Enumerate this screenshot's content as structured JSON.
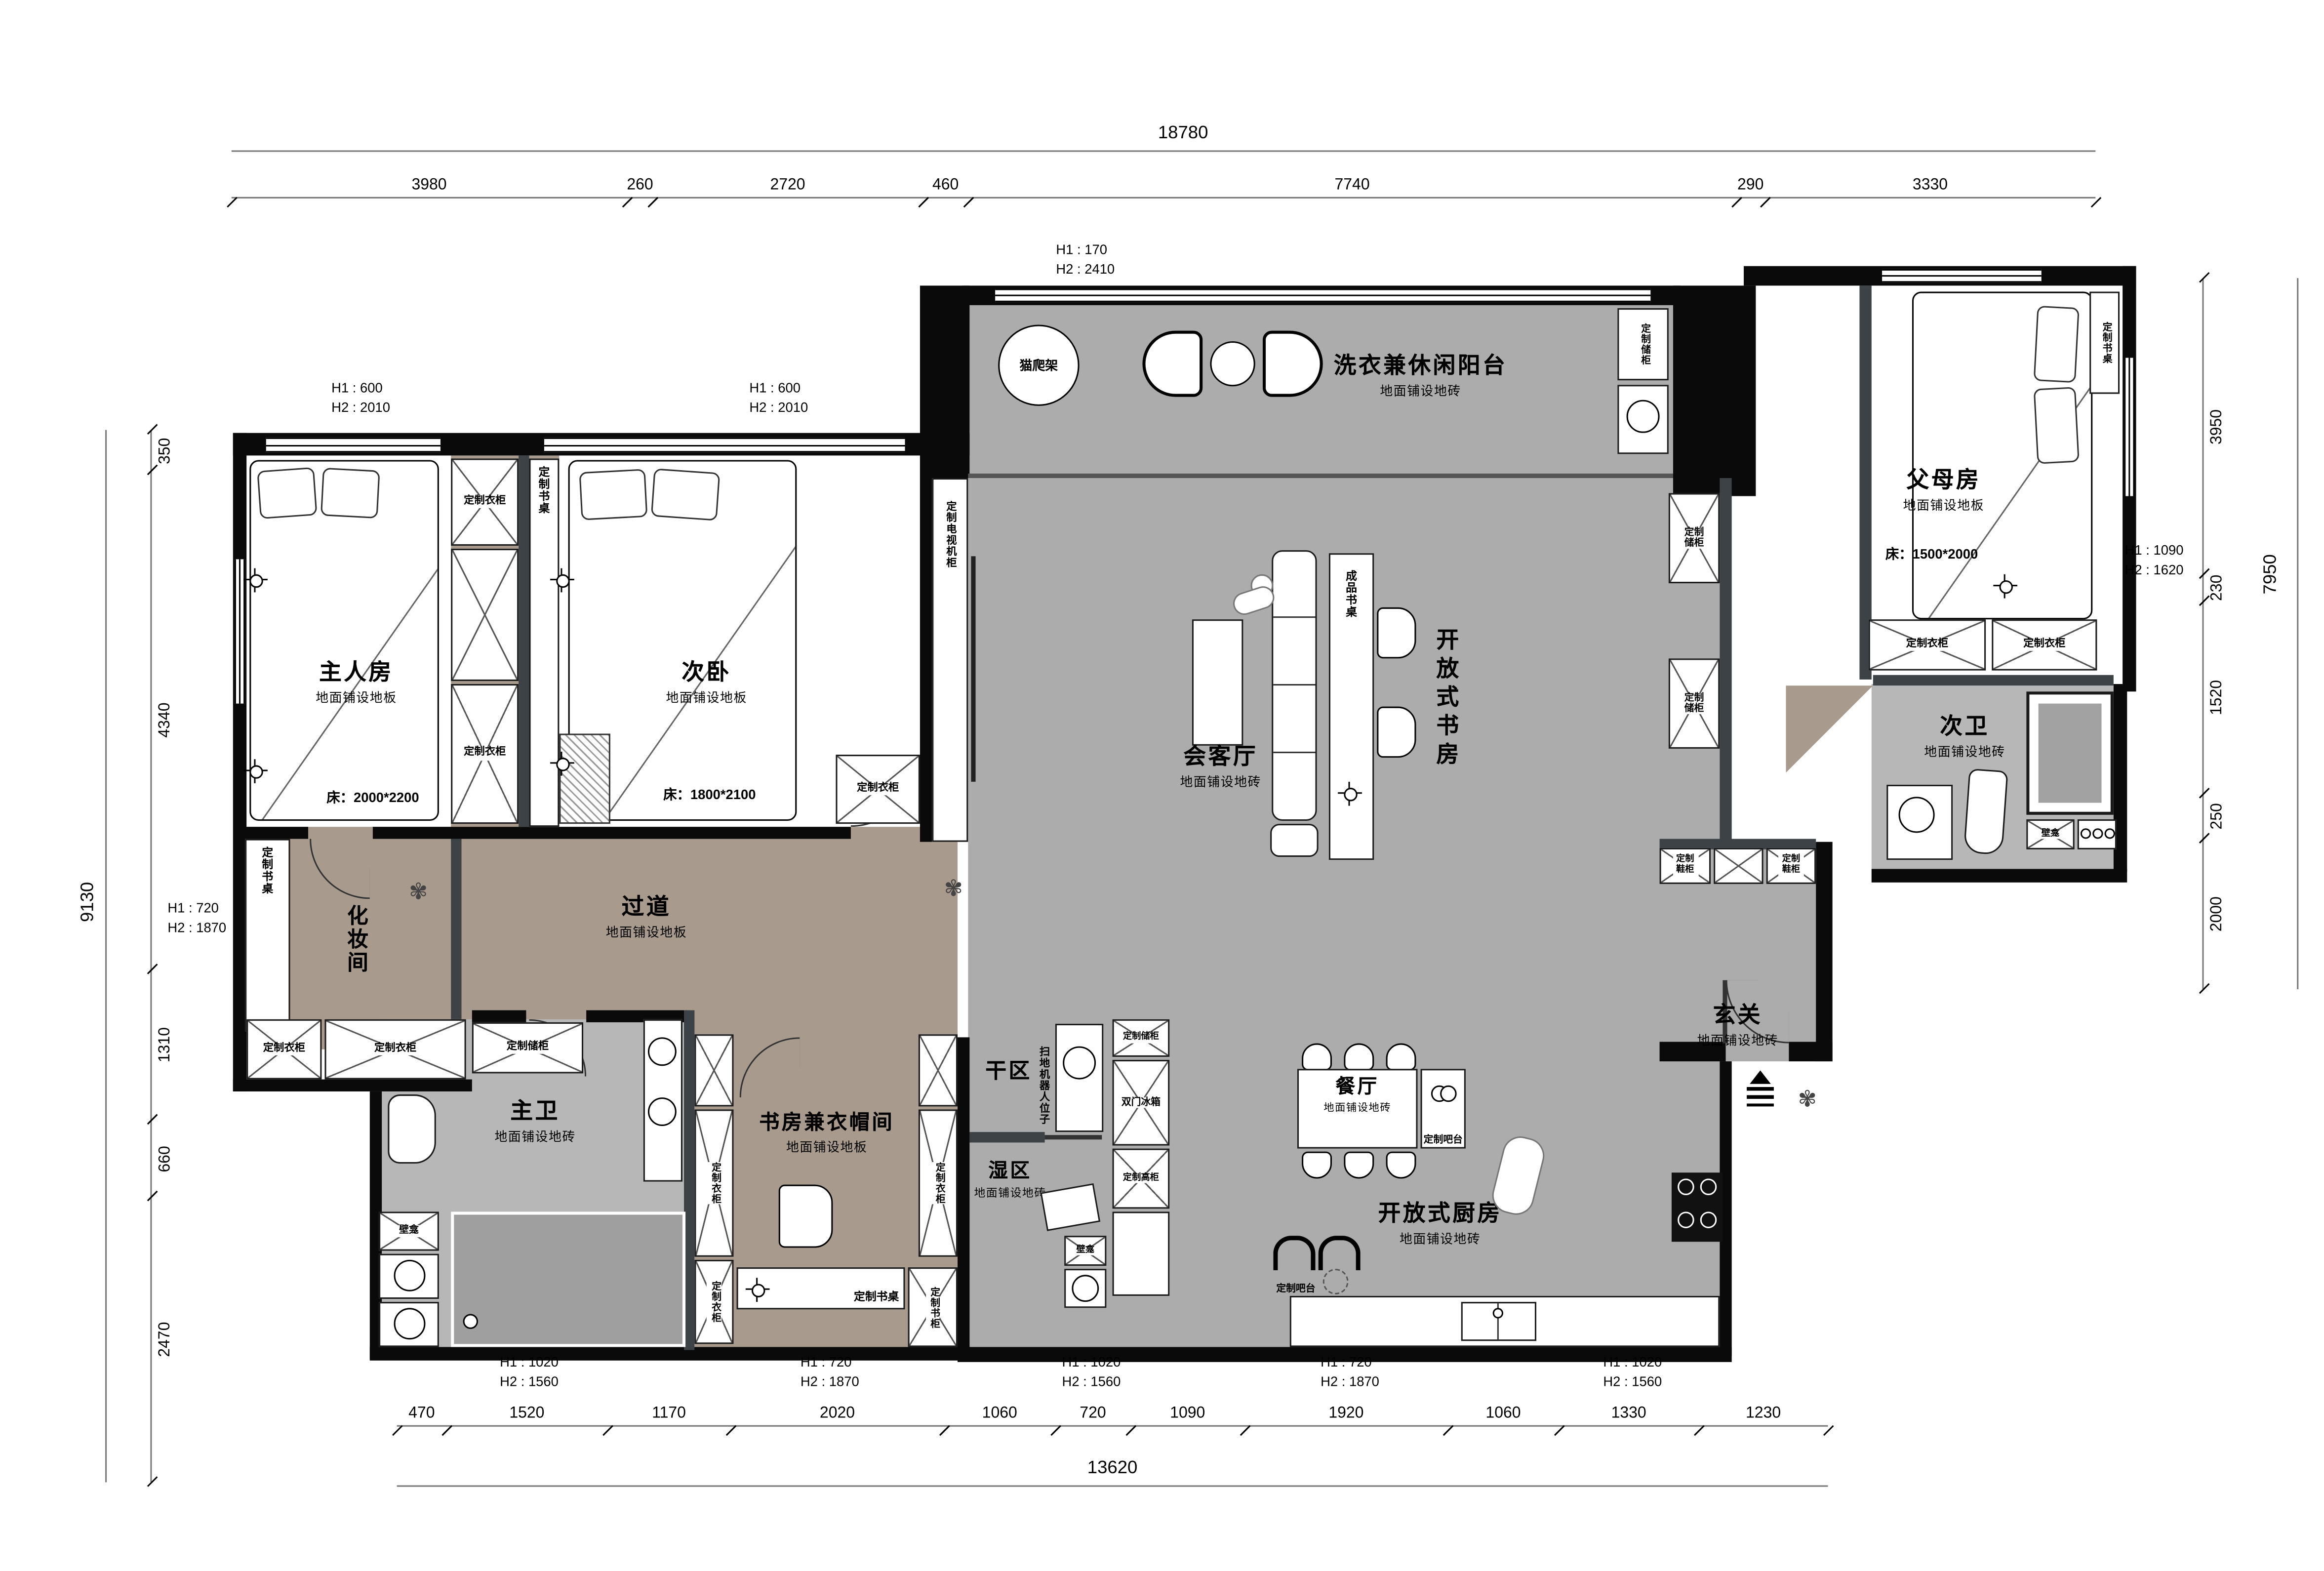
{
  "dims": {
    "top_total": "18780",
    "top": [
      "3980",
      "260",
      "2720",
      "460",
      "7740",
      "290",
      "3330"
    ],
    "bottom": [
      "470",
      "1520",
      "1170",
      "2020",
      "1060",
      "720",
      "1090",
      "1920",
      "1060",
      "1330",
      "1230"
    ],
    "bottom_total": "13620",
    "left": [
      "350",
      "4340",
      "1310",
      "660",
      "2470"
    ],
    "left_total": "9130",
    "right": [
      "3950",
      "230",
      "1520",
      "250",
      "2000"
    ],
    "right_total": "7950"
  },
  "hnotes": {
    "balcony": {
      "l1": "H1 : 170",
      "l2": "H2 : 2410"
    },
    "master": {
      "l1": "H1 : 600",
      "l2": "H2 : 2010"
    },
    "second": {
      "l1": "H1 : 600",
      "l2": "H2 : 2010"
    },
    "makeup": {
      "l1": "H1 : 720",
      "l2": "H2 : 1870"
    },
    "right": {
      "l1": "H1 : 1090",
      "l2": "H2 : 1620"
    },
    "b1": {
      "l1": "H1 : 1020",
      "l2": "H2 : 1560"
    },
    "b2": {
      "l1": "H1 : 720",
      "l2": "H2 : 1870"
    },
    "b3": {
      "l1": "H1 : 1020",
      "l2": "H2 : 1560"
    },
    "b4": {
      "l1": "H1 : 720",
      "l2": "H2 : 1870"
    },
    "b5": {
      "l1": "H1 : 1020",
      "l2": "H2 : 1560"
    }
  },
  "rooms": {
    "master": {
      "name": "主人房",
      "floor": "地面铺设地板",
      "bed": "床：2000*2200"
    },
    "second": {
      "name": "次卧",
      "floor": "地面铺设地板",
      "bed": "床：1800*2100"
    },
    "balcony": {
      "name": "洗衣兼休闲阳台",
      "floor": "地面铺设地砖"
    },
    "parents": {
      "name": "父母房",
      "floor": "地面铺设地板",
      "bed": "床：1500*2000"
    },
    "living": {
      "name": "会客厅",
      "floor": "地面铺设地砖"
    },
    "open_study": {
      "name": "开放式书房"
    },
    "bath2": {
      "name": "次卫",
      "floor": "地面铺设地砖"
    },
    "makeup": {
      "name": "化妆间"
    },
    "corridor": {
      "name": "过道",
      "floor": "地面铺设地板"
    },
    "bath1": {
      "name": "主卫",
      "floor": "地面铺设地砖"
    },
    "study": {
      "name": "书房兼衣帽间",
      "floor": "地面铺设地板"
    },
    "dry": {
      "name": "干区"
    },
    "wet": {
      "name": "湿区",
      "floor": "地面铺设地砖"
    },
    "dining": {
      "name": "餐厅",
      "floor": "地面铺设地砖"
    },
    "kitchen": {
      "name": "开放式厨房",
      "floor": "地面铺设地砖"
    },
    "entry": {
      "name": "玄关",
      "floor": "地面铺设地砖"
    }
  },
  "labels": {
    "wardrobe": "定制衣柜",
    "desk": "定制书桌",
    "bookcase": "定制书柜",
    "storage": "定制储柜",
    "tall_cabinet": "定制高柜",
    "shoe_cabinet": "定制鞋柜",
    "bar": "定制吧台",
    "fridge": "双门冰箱",
    "niche": "壁龛",
    "cat_tree": "猫爬架",
    "ready_desk": "成品书桌",
    "robot_spot": "扫地机器人位子",
    "tv_cabinet": "定制电视机柜"
  },
  "colors": {
    "wood": "#a89a8c",
    "tile": "#acacac",
    "wall": "#0a0a0a",
    "partition": "#3d4246"
  }
}
